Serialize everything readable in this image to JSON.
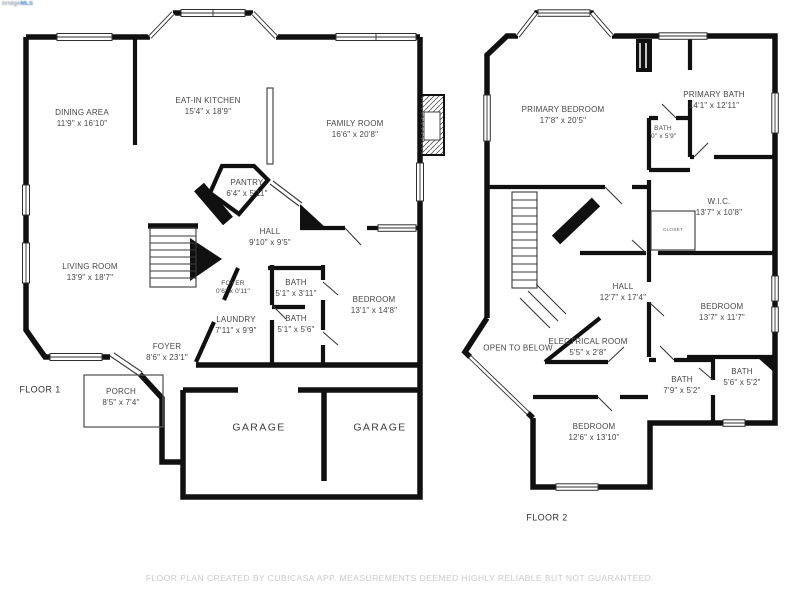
{
  "watermark": {
    "part1": "bridge",
    "part2": "MLS"
  },
  "footer": "FLOOR PLAN CREATED BY CUBICASA APP. MEASUREMENTS DEEMED HIGHLY RELIABLE BUT NOT GUARANTEED.",
  "floor1": {
    "label": "FLOOR 1",
    "rooms": {
      "dining": {
        "name": "DINING AREA",
        "dims": "11'9\" x 16'10\""
      },
      "kitchen": {
        "name": "EAT-IN KITCHEN",
        "dims": "15'4\" x 18'9\""
      },
      "family": {
        "name": "FAMILY ROOM",
        "dims": "16'6\" x 20'8\""
      },
      "pantry": {
        "name": "PANTRY",
        "dims": "6'4\" x 5'11\""
      },
      "hall": {
        "name": "HALL",
        "dims": "9'10\" x 9'5\""
      },
      "living": {
        "name": "LIVING ROOM",
        "dims": "13'9\" x 18'7\""
      },
      "foyersm": {
        "name": "FOYER",
        "dims": "0'6\" x 0'11\""
      },
      "bath_a": {
        "name": "BATH",
        "dims": "5'1\" x 3'11\""
      },
      "bath_b": {
        "name": "BATH",
        "dims": "5'1\" x 5'6\""
      },
      "laundry": {
        "name": "LAUNDRY",
        "dims": "7'11\" x 9'9\""
      },
      "bedroom": {
        "name": "BEDROOM",
        "dims": "13'1\" x 14'8\""
      },
      "foyer": {
        "name": "FOYER",
        "dims": "8'6\" x 23'1\""
      },
      "porch": {
        "name": "PORCH",
        "dims": "8'5\" x 7'4\""
      },
      "garage_l": {
        "name": "GARAGE"
      },
      "garage_r": {
        "name": "GARAGE"
      }
    }
  },
  "floor2": {
    "label": "FLOOR 2",
    "rooms": {
      "primary_bedroom": {
        "name": "PRIMARY BEDROOM",
        "dims": "17'8\" x 20'5\""
      },
      "primary_bath": {
        "name": "PRIMARY BATH",
        "dims": "14'1\" x 12'11\""
      },
      "bath_small": {
        "name": "BATH",
        "dims": "'0\" x 5'9\""
      },
      "wic": {
        "name": "W.I.C.",
        "dims": "13'7\" x 10'8\""
      },
      "closet": {
        "name": "CLOSET"
      },
      "hall": {
        "name": "HALL",
        "dims": "12'7\" x 17'4\""
      },
      "bedroom_right": {
        "name": "BEDROOM",
        "dims": "13'7\" x 11'7\""
      },
      "open_below": {
        "name": "OPEN TO BELOW"
      },
      "electrical": {
        "name": "ELECTRICAL ROOM",
        "dims": "5'5\" x 2'8\""
      },
      "bath_c": {
        "name": "BATH",
        "dims": "7'9\" x 5'2\""
      },
      "bath_d": {
        "name": "BATH",
        "dims": "5'6\" x 5'2\""
      },
      "bedroom_bottom": {
        "name": "BEDROOM",
        "dims": "12'6\" x 13'10\""
      }
    }
  }
}
